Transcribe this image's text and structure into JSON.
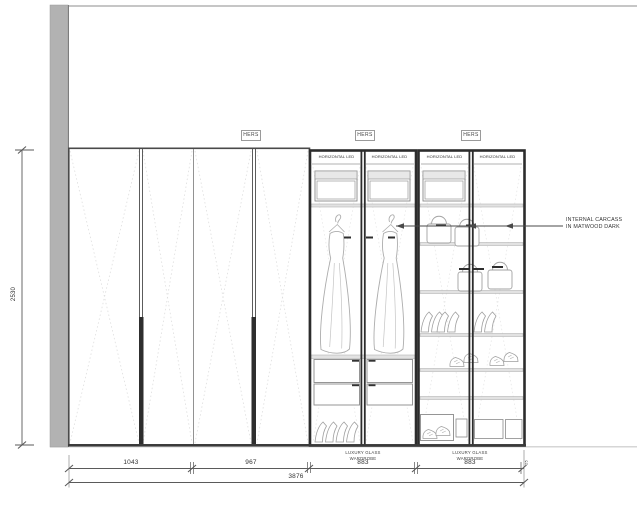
{
  "drawing": {
    "section_labels": {
      "hers": "HERS"
    },
    "feature_labels": {
      "horizontal_led": "HORIZONTAL LED",
      "luxury_glass_line1": "LUXURY GLASS",
      "luxury_glass_line2": "WARDROBE"
    },
    "annotation": {
      "line1": "INTERNAL CARCASS",
      "line2": "IN MATWOOD DARK"
    },
    "dimensions": {
      "height_mm": "2530",
      "bay_1": "1043",
      "bay_2": "967",
      "bay_3": "883",
      "bay_4": "883",
      "end_panel": "25",
      "total_width": "3876"
    },
    "palette": {
      "wall_gray": "#b2b2b2",
      "frame_dark": "#2c2c2c",
      "line_gray": "#8a8a8a",
      "dotted_light": "#dedede",
      "text_color": "#3a3a3a"
    }
  }
}
